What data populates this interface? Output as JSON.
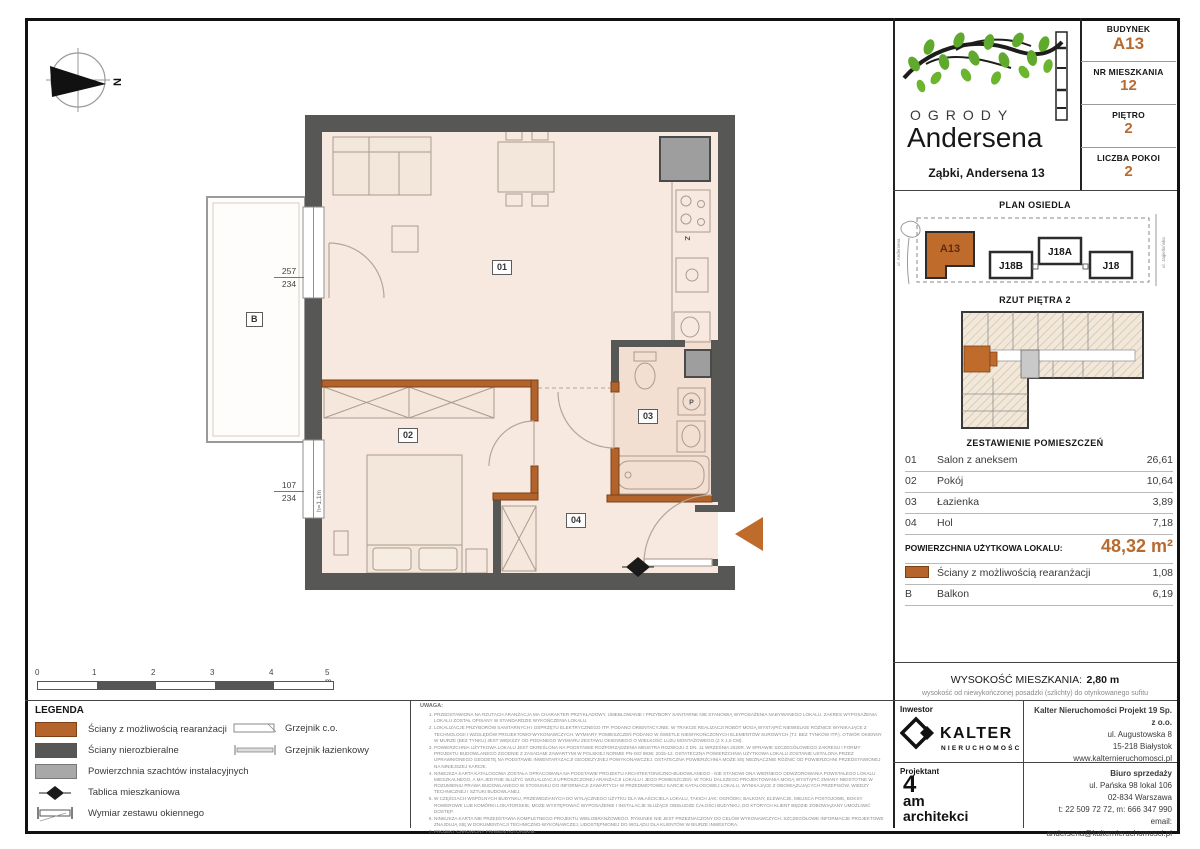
{
  "header": {
    "logo": {
      "line1": "OGRODY",
      "line2": "Andersena"
    },
    "location": "Ząbki, Andersena 13",
    "info_rows": [
      {
        "label": "BUDYNEK",
        "value": "A13"
      },
      {
        "label": "NR MIESZKANIA",
        "value": "12"
      },
      {
        "label": "PIĘTRO",
        "value": "2"
      },
      {
        "label": "LICZBA POKOI",
        "value": "2"
      }
    ]
  },
  "site_plan": {
    "title": "PLAN OSIEDLA",
    "buildings": {
      "a13": "A13",
      "j18b": "J18B",
      "j18a": "J18A",
      "j18": "J18"
    },
    "street_left": "ul. Andersena",
    "street_right": "ul. Jagiellońska"
  },
  "floor_overview": {
    "title": "RZUT PIĘTRA 2"
  },
  "rooms": {
    "title": "ZESTAWIENIE POMIESZCZEŃ",
    "rows": [
      {
        "no": "01",
        "name": "Salon z aneksem",
        "area": "26,61"
      },
      {
        "no": "02",
        "name": "Pokój",
        "area": "10,64"
      },
      {
        "no": "03",
        "name": "Łazienka",
        "area": "3,89"
      },
      {
        "no": "04",
        "name": "Hol",
        "area": "7,18"
      }
    ],
    "total_label": "POWIERZCHNIA UŻYTKOWA LOKALU:",
    "total_value": "48,32 m²",
    "extra_rows": [
      {
        "no": "",
        "name": "Ściany z możliwością rearanżacji",
        "area": "1,08"
      },
      {
        "no": "B",
        "name": "Balkon",
        "area": "6,19"
      }
    ]
  },
  "height_info": {
    "label": "WYSOKOŚĆ MIESZKANIA:",
    "value": "2,80 m",
    "note": "wysokość od niewykończonej posadzki (szlichty) do otynkowanego sufitu"
  },
  "plan": {
    "labels": {
      "salon": "01",
      "pokoj": "02",
      "lazienka": "03",
      "hol": "04",
      "balkon": "B"
    },
    "dim_upper": {
      "top": "257",
      "bottom": "234"
    },
    "dim_lower": {
      "top": "107",
      "bottom": "234"
    },
    "window_note": "h=1,1m",
    "sink": "Z",
    "washer": "P",
    "compass": "N"
  },
  "scale_bar": {
    "labels": [
      "0",
      "1",
      "2",
      "3",
      "4",
      "5 m"
    ]
  },
  "legend": {
    "title": "LEGENDA",
    "items": [
      {
        "label": "Ściany z możliwością rearanżacji"
      },
      {
        "label": "Ściany nierozbieralne"
      },
      {
        "label": "Powierzchnia szachtów instalacyjnych"
      },
      {
        "label": "Tablica mieszkaniowa"
      },
      {
        "label": "Wymiar zestawu okiennego"
      }
    ],
    "radiators": [
      {
        "label": "Grzejnik c.o."
      },
      {
        "label": "Grzejnik łazienkowy"
      }
    ]
  },
  "notes": {
    "title": "UWAGA:",
    "items": [
      "PRZEDSTAWIONA NA RZUTACH ARANŻACJA MA CHARAKTER PRZYKŁADOWY. UMEBLOWANIE I PRZYBORY SANITARNE NIE STANOWIĄ WYPOSAŻENIA NABYWANEGO LOKALU. ZAKRES WYPOSAŻENIA LOKALU ZOSTAŁ OPISANY W STANDARDZIE WYKOŃCZENIA LOKALU.",
      "LOKALIZACJE PRZYBORÓW SANITARNYCH I OSPRZĘTU ELEKTRYCZNEGO ITP. PODANO ORIENTACYJNIE. W TRAKCIE REALIZACJI ROBÓT MOGĄ WYSTĄPIĆ NIEWIELKIE RÓŻNICE WYNIKAJĄCE Z TECHNOLOGII I WZGLĘDÓW PROJEKTOWO-WYKONAWCZYCH. WYMIARY POMIESZCZEŃ PODANO W ŚWIETLE NIEWYKOŃCZONYCH ELEMENTÓW SUROWYCH (TJ. BEZ TYNKÓW ITP.). OTWÓR OKIENNY W MURZE (BEZ TYNKU) JEST WIĘKSZY OD PODANEGO WYMIARU ZESTAWU OKIENNEGO O WIELKOŚĆ LUZU MONTAŻOWEGO (2 X 1,5 CM).",
      "POWIERZCHNIA UŻYTKOWA LOKALU JEST OKREŚLONA NA PODSTAWIE ROZPORZĄDZENIA MINISTRA ROZWOJU Z DN. 11 WRZEŚNIA 2020R. W SPRAWIE SZCZEGÓŁOWEGO ZAKRESU I FORMY PROJEKTU BUDOWLANEGO ZGODNIE Z ZASADAMI ZAWARTYMI W POLSKIEJ NORMIE PN-ISO 9836: 2015-12. OSTATECZNA POWIERZCHNIA UŻYTKOWA LOKALU ZOSTANIE USTALONA PRZEZ UPRAWNIONEGO GEODETĘ NA PODSTAWIE INWENTARYZACJI GEODEZYJNEJ POWYKONAWCZEJ. OSTATECZNA POWIERZCHNIA MOŻE SIĘ NIEZNACZNIE RÓŻNIĆ OD POWIERZCHNI PRZEDSTAWIONEJ NA NINIEJSZEJ KARCIE.",
      "NINIEJSZA KARTA KATALOGOWA ZOSTAŁA OPRACOWANA NA PODSTAWIE PROJEKTU ARCHITEKTONICZNO-BUDOWLANEGO - NIE STANOWI ONA WIERNEGO ODWZOROWANIA POWSTAŁEGO LOKALU MIESZKALNEGO, A MA JEDYNIE SŁUŻYĆ WIZUALIZACJI UPROSZCZONEJ ARANŻACJI LOKALU I JEGO POMIESZCZEŃ. W TOKU DALSZEGO PROJEKTOWANIA MOGĄ WYSTĄPIĆ ZMIANY NIEISTOTNE W ROZUMIENIU PRAWA BUDOWLANEGO W STOSUNKU DO INFORMACJI ZAWARTYCH W PRZEDMIOTOWEJ KARCIE KATALOGOWEJ LOKALU, WYNIKAJĄCE Z OBOWIĄZUJĄCYCH PRZEPISÓW, WIEDZY TECHNICZNEJ I SZTUKI BUDOWLANEJ.",
      "W CZĘŚCIACH WSPÓLNYCH BUDYNKU, PRZEWIDZIANYCH DO WYŁĄCZNEGO UŻYTKU DLA WŁAŚCICIELA LOKALU, TAKICH JAK: OGRÓDKI, BALKONY, ELEWACJE, MIEJSCA POSTOJOWE, BOKSY ROWEROWE LUB KOMÓRKI LOKATORSKIE, MOŻE WYSTĘPOWAĆ WYPOSAŻENIE I INSTALACJE SŁUŻĄCE OBSŁUDZE CAŁOŚCI BUDYNKU, DO KTÓRYCH KLIENT BĘDZIE ZOBOWIĄZANY UMOŻLIWIĆ DOSTĘP.",
      "NINIEJSZA KARTA NIE PRZEDSTAWIA KOMPLETNEGO PROJEKTU WIELOBRANŻOWEGO. RYSUNEK NIE JEST PRZEZNACZONY DO CELÓW WYKONAWCZYCH. SZCZEGÓŁOWE INFORMACJE PROJEKTOWE ZNAJDUJĄ SIĘ W DOKUMENTACJI TECHNICZNO-WYKONAWCZEJ, UDOSTĘPNIONEJ DO WGLĄDU DLA KLIENTÓW W BIURZE INWESTORA.",
      "PROJEKT CHRONIONY PRAWEM AUTORSKIM."
    ]
  },
  "companies": {
    "investor_label": "Inwestor",
    "investor_name": "KALTER",
    "investor_subtitle": "NIERUCHOMOŚCI",
    "hq_name": "Kalter Nieruchomości Projekt 19 Sp. z o.o.",
    "hq_lines": [
      "ul. Augustowska 8",
      "15-218 Białystok",
      "www.kalternieruchomosci.pl"
    ],
    "designer_label": "Projektant",
    "designer_l1": "4",
    "designer_l2": "am",
    "designer_l3": "architekci",
    "sales_title": "Biuro sprzedaży",
    "sales_lines": [
      "ul. Pańska 98 lokal 106",
      "02-834 Warszawa",
      "t: 22 509 72 72, m: 666 347 990",
      "email: andersena@kalternieruchomosci.pl"
    ]
  },
  "colors": {
    "accent": "#b96a2e",
    "orange_wall": "#b2622b",
    "wall": "#575756",
    "shaft": "#9e9e9e",
    "floor": "#f7e9e0",
    "bath_floor": "#f3ded2",
    "leaf_green": "#5fa92c"
  }
}
